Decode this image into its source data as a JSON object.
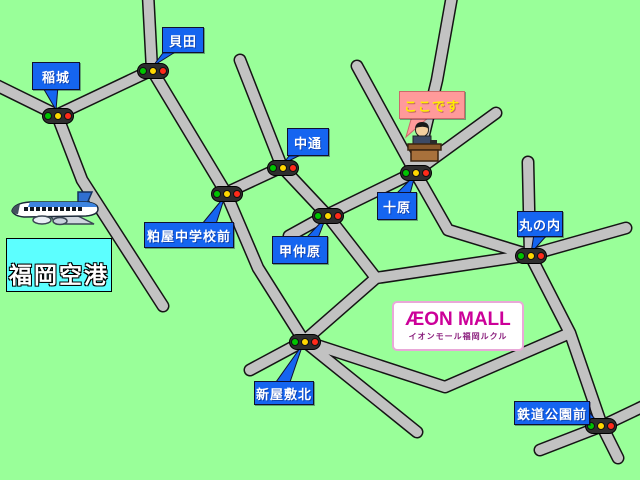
{
  "map_labels": {
    "inagi": {
      "text": "稲城"
    },
    "kaida": {
      "text": "貝田"
    },
    "nakadori": {
      "text": "中通"
    },
    "kasuya_jhs_mae": {
      "text": "粕屋中学校前"
    },
    "konakabaru": {
      "text": "甲仲原"
    },
    "jubaru": {
      "text": "十原"
    },
    "marunouchi": {
      "text": "丸の内"
    },
    "shinyashiki_kita": {
      "text": "新屋敷北"
    },
    "tetsudo_koen_mae": {
      "text": "鉄道公園前"
    }
  },
  "here_label": {
    "text": "ここです"
  },
  "airport": {
    "text": "福岡空港"
  },
  "mall": {
    "title": "ÆON MALL",
    "subtitle": "イオンモール福岡ルクル"
  },
  "colors": {
    "background": "#99ff99",
    "road_fill": "#c2c2c2",
    "road_outline": "#151515",
    "label_bubble": "#1565f0",
    "here_bubble": "#ff9a9a",
    "here_text": "#ffee00",
    "airport_box": "#5cffff",
    "mall_brand": "#cc0099",
    "signal_green": "#00c400",
    "signal_yellow": "#ffd800",
    "signal_red": "#ff2a1a"
  },
  "icons": {
    "signal": "traffic-signal-icon",
    "airplane": "airplane-icon",
    "reception": "reception-desk-icon"
  }
}
